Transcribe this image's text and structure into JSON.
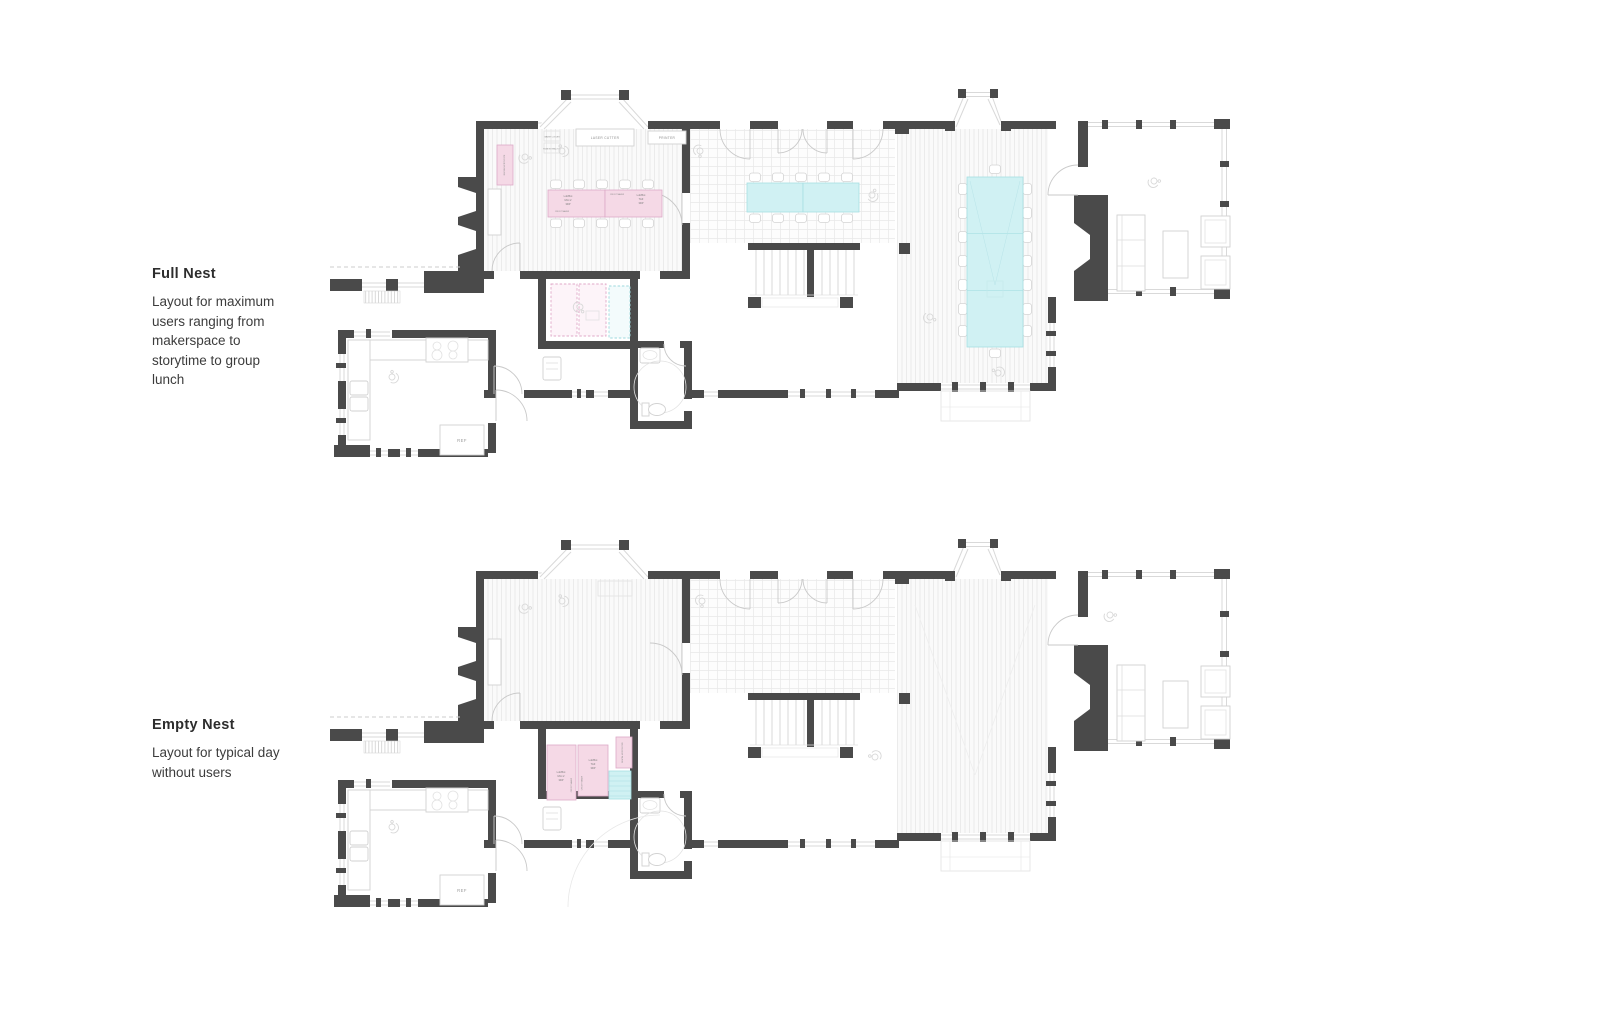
{
  "page": {
    "background": "#ffffff"
  },
  "colors": {
    "wall": "#4a4a4a",
    "pink_table": "#f5d9e6",
    "cyan_table": "#d0f1f3",
    "floor_line": "#eaeaea",
    "annotation_text": "#3c3c3c"
  },
  "annotations": [
    {
      "title": "Full Nest",
      "description": "Layout for maximum users ranging from makerspace to storytime to group lunch"
    },
    {
      "title": "Empty Nest",
      "description": "Layout for typical day without users"
    }
  ],
  "labels": {
    "laser_cutter": "LASER CUTTER",
    "printer": "PRINTER",
    "water_cooler": "WATER COOLER",
    "fume_extractor": "FUME EXTRACTOR",
    "refrigerator": "REF",
    "lulzbot_mini_l1": "LulzBot",
    "lulzbot_mini_l2": "Mini 2",
    "lulzbot_mini_l3": "3DP",
    "lulzbot_taz_l1": "LulzBot",
    "lulzbot_taz_l2": "TAZ",
    "lulzbot_taz_l3": "3DP",
    "cricut_maker": "CRICUT MAKER",
    "digital_microscope": "DIGITAL MICROSCOPE"
  }
}
